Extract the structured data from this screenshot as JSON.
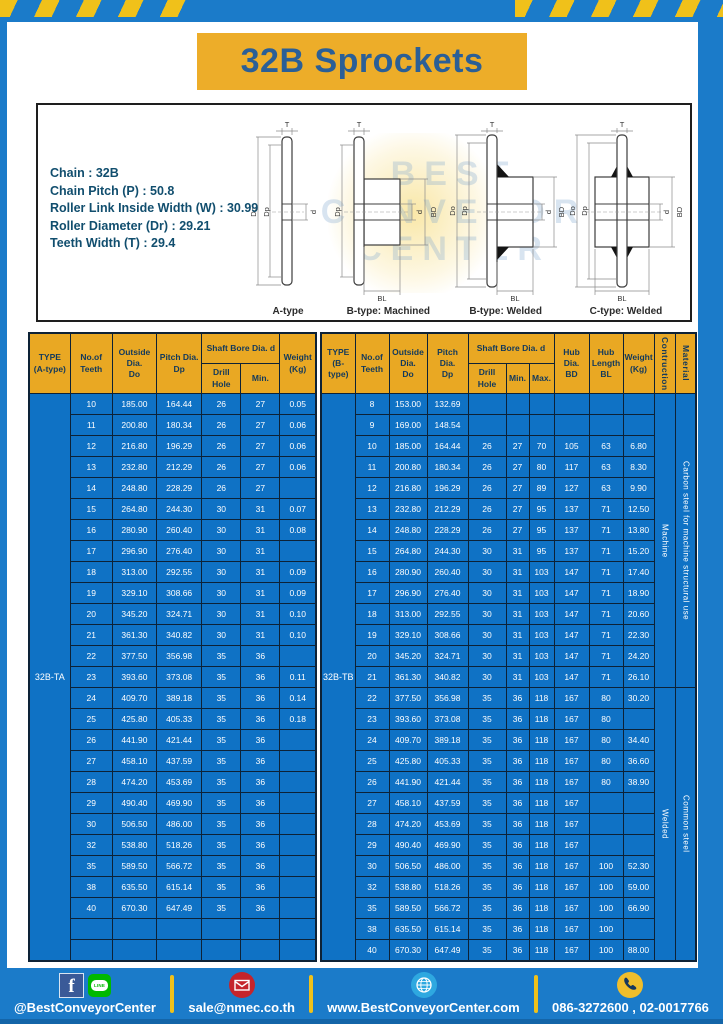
{
  "title": "32B Sprockets",
  "specs": {
    "lines": [
      "Chain : 32B",
      "Chain Pitch (P) : 50.8",
      "Roller Link Inside Width (W) : 30.99",
      "Roller Diameter (Dr) : 29.21",
      "Teeth Width (T) : 29.4"
    ]
  },
  "watermark": {
    "lines": [
      "BEST",
      "CONVEYOR",
      "CENTER"
    ]
  },
  "drawings": {
    "labels": [
      "A-type",
      "B-type: Machined",
      "B-type: Welded",
      "C-type: Welded"
    ],
    "dims": {
      "t": "T",
      "do": "Do",
      "dp": "Dp",
      "d": "d",
      "bd": "BD",
      "bl": "BL"
    }
  },
  "colors": {
    "frame_blue": "#1B7BC9",
    "cell_blue": "#0F72C5",
    "header_yellow": "#E9A823",
    "stripe_yellow": "#F0C11A",
    "title_text_blue": "#2B5F96"
  },
  "table_a": {
    "headers": {
      "type": "TYPE\n(A-type)",
      "teeth": "No.of\nTeeth",
      "outside": "Outside\nDia.\nDo",
      "pitch": "Pitch Dia.\nDp",
      "shaft_bore": "Shaft Bore Dia. d",
      "drill_hole": "Drill Hole",
      "min": "Min.",
      "weight": "Weight\n(Kg)"
    },
    "type_value": "32B-TA",
    "empty_rows": 2,
    "rows": [
      [
        "10",
        "185.00",
        "164.44",
        "26",
        "27",
        "0.05"
      ],
      [
        "11",
        "200.80",
        "180.34",
        "26",
        "27",
        "0.06"
      ],
      [
        "12",
        "216.80",
        "196.29",
        "26",
        "27",
        "0.06"
      ],
      [
        "13",
        "232.80",
        "212.29",
        "26",
        "27",
        "0.06"
      ],
      [
        "14",
        "248.80",
        "228.29",
        "26",
        "27",
        ""
      ],
      [
        "15",
        "264.80",
        "244.30",
        "30",
        "31",
        "0.07"
      ],
      [
        "16",
        "280.90",
        "260.40",
        "30",
        "31",
        "0.08"
      ],
      [
        "17",
        "296.90",
        "276.40",
        "30",
        "31",
        ""
      ],
      [
        "18",
        "313.00",
        "292.55",
        "30",
        "31",
        "0.09"
      ],
      [
        "19",
        "329.10",
        "308.66",
        "30",
        "31",
        "0.09"
      ],
      [
        "20",
        "345.20",
        "324.71",
        "30",
        "31",
        "0.10"
      ],
      [
        "21",
        "361.30",
        "340.82",
        "30",
        "31",
        "0.10"
      ],
      [
        "22",
        "377.50",
        "356.98",
        "35",
        "36",
        ""
      ],
      [
        "23",
        "393.60",
        "373.08",
        "35",
        "36",
        "0.11"
      ],
      [
        "24",
        "409.70",
        "389.18",
        "35",
        "36",
        "0.14"
      ],
      [
        "25",
        "425.80",
        "405.33",
        "35",
        "36",
        "0.18"
      ],
      [
        "26",
        "441.90",
        "421.44",
        "35",
        "36",
        ""
      ],
      [
        "27",
        "458.10",
        "437.59",
        "35",
        "36",
        ""
      ],
      [
        "28",
        "474.20",
        "453.69",
        "35",
        "36",
        ""
      ],
      [
        "29",
        "490.40",
        "469.90",
        "35",
        "36",
        ""
      ],
      [
        "30",
        "506.50",
        "486.00",
        "35",
        "36",
        ""
      ],
      [
        "32",
        "538.80",
        "518.26",
        "35",
        "36",
        ""
      ],
      [
        "35",
        "589.50",
        "566.72",
        "35",
        "36",
        ""
      ],
      [
        "38",
        "635.50",
        "615.14",
        "35",
        "36",
        ""
      ],
      [
        "40",
        "670.30",
        "647.49",
        "35",
        "36",
        ""
      ]
    ]
  },
  "table_b": {
    "headers": {
      "type": "TYPE\n(B-type)",
      "teeth": "No.of\nTeeth",
      "outside": "Outside\nDia.\nDo",
      "pitch": "Pitch Dia.\nDp",
      "shaft_bore": "Shaft Bore Dia. d",
      "drill_hole": "Drill Hole",
      "min": "Min.",
      "max": "Max.",
      "hub_dia": "Hub Dia.\nBD",
      "hub_length": "Hub\nLength\nBL",
      "weight": "Weight\n(Kg)",
      "construction": "Contruction",
      "material": "Material"
    },
    "type_value": "32B-TB",
    "groups": [
      {
        "span": 14,
        "construction": "Machine",
        "material": "Carbon steel for machine structural use"
      },
      {
        "span": 13,
        "construction": "Welded",
        "material": "Common steel"
      }
    ],
    "rows": [
      [
        "8",
        "153.00",
        "132.69",
        "",
        "",
        "",
        "",
        "",
        ""
      ],
      [
        "9",
        "169.00",
        "148.54",
        "",
        "",
        "",
        "",
        "",
        ""
      ],
      [
        "10",
        "185.00",
        "164.44",
        "26",
        "27",
        "70",
        "105",
        "63",
        "6.80"
      ],
      [
        "11",
        "200.80",
        "180.34",
        "26",
        "27",
        "80",
        "117",
        "63",
        "8.30"
      ],
      [
        "12",
        "216.80",
        "196.29",
        "26",
        "27",
        "89",
        "127",
        "63",
        "9.90"
      ],
      [
        "13",
        "232.80",
        "212.29",
        "26",
        "27",
        "95",
        "137",
        "71",
        "12.50"
      ],
      [
        "14",
        "248.80",
        "228.29",
        "26",
        "27",
        "95",
        "137",
        "71",
        "13.80"
      ],
      [
        "15",
        "264.80",
        "244.30",
        "30",
        "31",
        "95",
        "137",
        "71",
        "15.20"
      ],
      [
        "16",
        "280.90",
        "260.40",
        "30",
        "31",
        "103",
        "147",
        "71",
        "17.40"
      ],
      [
        "17",
        "296.90",
        "276.40",
        "30",
        "31",
        "103",
        "147",
        "71",
        "18.90"
      ],
      [
        "18",
        "313.00",
        "292.55",
        "30",
        "31",
        "103",
        "147",
        "71",
        "20.60"
      ],
      [
        "19",
        "329.10",
        "308.66",
        "30",
        "31",
        "103",
        "147",
        "71",
        "22.30"
      ],
      [
        "20",
        "345.20",
        "324.71",
        "30",
        "31",
        "103",
        "147",
        "71",
        "24.20"
      ],
      [
        "21",
        "361.30",
        "340.82",
        "30",
        "31",
        "103",
        "147",
        "71",
        "26.10"
      ],
      [
        "22",
        "377.50",
        "356.98",
        "35",
        "36",
        "118",
        "167",
        "80",
        "30.20"
      ],
      [
        "23",
        "393.60",
        "373.08",
        "35",
        "36",
        "118",
        "167",
        "80",
        ""
      ],
      [
        "24",
        "409.70",
        "389.18",
        "35",
        "36",
        "118",
        "167",
        "80",
        "34.40"
      ],
      [
        "25",
        "425.80",
        "405.33",
        "35",
        "36",
        "118",
        "167",
        "80",
        "36.60"
      ],
      [
        "26",
        "441.90",
        "421.44",
        "35",
        "36",
        "118",
        "167",
        "80",
        "38.90"
      ],
      [
        "27",
        "458.10",
        "437.59",
        "35",
        "36",
        "118",
        "167",
        "",
        ""
      ],
      [
        "28",
        "474.20",
        "453.69",
        "35",
        "36",
        "118",
        "167",
        "",
        ""
      ],
      [
        "29",
        "490.40",
        "469.90",
        "35",
        "36",
        "118",
        "167",
        "",
        ""
      ],
      [
        "30",
        "506.50",
        "486.00",
        "35",
        "36",
        "118",
        "167",
        "100",
        "52.30"
      ],
      [
        "32",
        "538.80",
        "518.26",
        "35",
        "36",
        "118",
        "167",
        "100",
        "59.00"
      ],
      [
        "35",
        "589.50",
        "566.72",
        "35",
        "36",
        "118",
        "167",
        "100",
        "66.90"
      ],
      [
        "38",
        "635.50",
        "615.14",
        "35",
        "36",
        "118",
        "167",
        "100",
        ""
      ],
      [
        "40",
        "670.30",
        "647.49",
        "35",
        "36",
        "118",
        "167",
        "100",
        "88.00"
      ]
    ]
  },
  "footer": {
    "social": "@BestConveyorCenter",
    "email": "sale@nmec.co.th",
    "website": "www.BestConveyorCenter.com",
    "phone": "086-3272600 , 02-0017766",
    "facebook_letter": "f",
    "line_text": "LINE"
  }
}
